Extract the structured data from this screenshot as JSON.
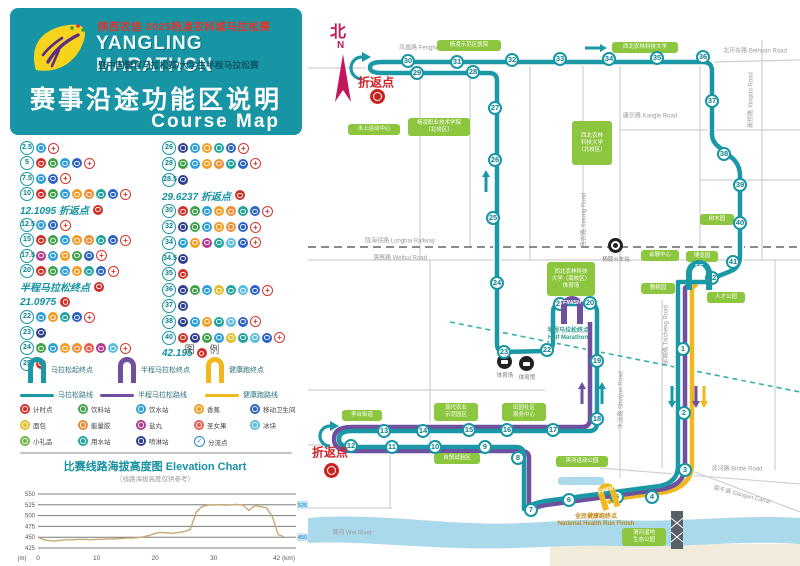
{
  "header": {
    "line1": "陕西农信·2025杨凌农科城马拉松赛",
    "title": "YANGLING MARATHON",
    "line3": "暨中国警官马拉松赛/大学生半程马拉松赛",
    "heading": "赛事沿途功能区说明",
    "subheading": "Course Map"
  },
  "km_list": {
    "left": [
      {
        "km": "2.5",
        "icons": [
          "water",
          "medical"
        ]
      },
      {
        "km": "5",
        "icons": [
          "timing",
          "drink",
          "water",
          "toilet",
          "medical"
        ]
      },
      {
        "km": "7.5",
        "icons": [
          "water",
          "toilet",
          "medical"
        ]
      },
      {
        "km": "10",
        "icons": [
          "timing",
          "drink",
          "water",
          "banana",
          "gel",
          "sponge",
          "toilet",
          "medical"
        ]
      },
      {
        "label": "12.1095 折返点",
        "icons": [
          "timing"
        ]
      },
      {
        "km": "12.5",
        "icons": [
          "water",
          "toilet",
          "medical"
        ]
      },
      {
        "km": "15",
        "icons": [
          "timing",
          "drink",
          "water",
          "banana",
          "gel",
          "sponge",
          "toilet",
          "medical"
        ]
      },
      {
        "km": "17.5",
        "icons": [
          "salt",
          "water",
          "banana",
          "drink",
          "toilet",
          "medical"
        ]
      },
      {
        "km": "20",
        "icons": [
          "timing",
          "drink",
          "water",
          "banana",
          "sponge",
          "toilet",
          "medical"
        ]
      },
      {
        "label": "半程马拉松终点",
        "icons": [
          "timing"
        ]
      },
      {
        "label": "21.0975",
        "icons": [
          "timing"
        ]
      },
      {
        "km": "22",
        "icons": [
          "water",
          "banana",
          "sponge",
          "toilet",
          "medical"
        ]
      },
      {
        "km": "23",
        "icons": [
          "spray"
        ]
      },
      {
        "km": "24",
        "icons": [
          "drink",
          "water",
          "banana",
          "gel",
          "fruit",
          "salt",
          "ice",
          "medical"
        ]
      },
      {
        "km": "25",
        "icons": [
          "timing"
        ]
      }
    ],
    "right": [
      {
        "km": "26",
        "icons": [
          "spray",
          "water",
          "banana",
          "sponge",
          "toilet",
          "medical"
        ]
      },
      {
        "km": "28",
        "icons": [
          "drink",
          "water",
          "banana",
          "gel",
          "sponge",
          "toilet",
          "medical"
        ]
      },
      {
        "km": "28.5",
        "icons": [
          "spray"
        ]
      },
      {
        "label": "29.6237 折返点",
        "icons": [
          "timing"
        ]
      },
      {
        "km": "30",
        "icons": [
          "timing",
          "drink",
          "water",
          "banana",
          "gel",
          "sponge",
          "toilet",
          "medical"
        ]
      },
      {
        "km": "32",
        "icons": [
          "spray",
          "drink",
          "water",
          "banana",
          "gel",
          "toilet",
          "medical"
        ]
      },
      {
        "km": "34",
        "icons": [
          "water",
          "banana",
          "salt",
          "sponge",
          "ice",
          "toilet",
          "medical"
        ]
      },
      {
        "km": "34.5",
        "icons": [
          "spray"
        ]
      },
      {
        "km": "35",
        "icons": [
          "timing"
        ]
      },
      {
        "km": "36",
        "icons": [
          "spray",
          "drink",
          "water",
          "bread",
          "sponge",
          "ice",
          "toilet",
          "medical"
        ]
      },
      {
        "km": "37",
        "icons": [
          "spray"
        ]
      },
      {
        "km": "38",
        "icons": [
          "spray",
          "water",
          "banana",
          "sponge",
          "ice",
          "toilet",
          "medical"
        ]
      },
      {
        "km": "40",
        "icons": [
          "timing",
          "spray",
          "drink",
          "water",
          "bread",
          "sponge",
          "ice",
          "toilet",
          "medical"
        ]
      },
      {
        "label": "42.195",
        "icons": [
          "timing"
        ]
      }
    ]
  },
  "legend": {
    "title": "图 例",
    "arches": [
      {
        "label": "马拉松起终点",
        "color": "#1b98a6"
      },
      {
        "label": "半程马拉松终点",
        "color": "#6f4f9e"
      },
      {
        "label": "健康跑终点",
        "color": "#f0b81f"
      }
    ],
    "routes": [
      {
        "label": "马拉松路线",
        "color": "#1b98a6"
      },
      {
        "label": "半程马拉松路线",
        "color": "#6f4f9e"
      },
      {
        "label": "健康跑路线",
        "color": "#f0b81f"
      }
    ],
    "items": [
      {
        "key": "timing",
        "label": "计时点"
      },
      {
        "key": "drink",
        "label": "饮料站"
      },
      {
        "key": "water",
        "label": "饮水站"
      },
      {
        "key": "banana",
        "label": "香蕉"
      },
      {
        "key": "toilet",
        "label": "移动卫生间"
      },
      {
        "key": "bread",
        "label": "面包"
      },
      {
        "key": "gel",
        "label": "能量胶"
      },
      {
        "key": "salt",
        "label": "盐丸"
      },
      {
        "key": "fruit",
        "label": "圣女果"
      },
      {
        "key": "ice",
        "label": "冰块"
      },
      {
        "key": "gift",
        "label": "小礼品"
      },
      {
        "key": "sponge",
        "label": "用水站"
      },
      {
        "key": "spray",
        "label": "喷淋站"
      },
      {
        "key": "split",
        "label": "分流点"
      }
    ],
    "icon_colors": {
      "timing": "#cf3129",
      "drink": "#3fa14a",
      "water": "#2e9fd6",
      "banana": "#f29d22",
      "toilet": "#2b62c4",
      "bread": "#e3bc2a",
      "gel": "#ef8b33",
      "salt": "#b23a8f",
      "fruit": "#e85d4c",
      "ice": "#5bbde0",
      "gift": "#6fb543",
      "sponge": "#21a39d",
      "spray": "#2e3f8f"
    }
  },
  "elevation": {
    "title_cn": "比赛线路海拔高度图",
    "title_en": "Elevation Chart",
    "note": "（线路海拔高度仅供参考）",
    "end_labels": [
      "525",
      "450"
    ]
  },
  "chart_data": {
    "type": "line",
    "title": "比赛线路海拔高度图 Elevation Chart",
    "xlabel": "距离 (km)",
    "ylabel": "海拔 (m)",
    "ylim": [
      425,
      550
    ],
    "yticks": [
      425,
      450,
      475,
      500,
      525,
      550
    ],
    "xticks": [
      0,
      10,
      20,
      30,
      42
    ],
    "x": [
      0,
      1,
      2,
      3,
      4,
      5,
      6,
      7,
      8,
      9,
      10,
      11,
      12,
      13,
      14,
      15,
      16,
      17,
      18,
      19,
      20,
      21,
      22,
      23,
      24,
      25,
      26,
      27,
      28,
      29,
      30,
      31,
      32,
      33,
      34,
      35,
      36,
      37,
      38,
      39,
      40,
      41,
      42
    ],
    "elevation_m": [
      450,
      444,
      442,
      441,
      443,
      444,
      444,
      445,
      445,
      444,
      445,
      445,
      446,
      446,
      447,
      448,
      448,
      449,
      451,
      454,
      459,
      461,
      460,
      459,
      461,
      463,
      468,
      508,
      521,
      524,
      525,
      525,
      524,
      525,
      526,
      524,
      512,
      523,
      521,
      518,
      498,
      456,
      451
    ],
    "line_color": "#c9a877",
    "grid": true
  },
  "map": {
    "north": {
      "cn": "北",
      "letter": "N"
    },
    "turnaround_label": "折返点",
    "start_finish_text": "S/F",
    "finish_text": "FINISH",
    "half_finish_label": {
      "lines": [
        "半程马拉松终点",
        "Half Marathon"
      ],
      "x": 568,
      "y": 328
    },
    "health_finish_label": {
      "lines": [
        "全民健康跑终点",
        "National Health Run Finish"
      ],
      "x": 596,
      "y": 514
    },
    "colors": {
      "marathon": "#1b98a6",
      "half": "#6f4f9e",
      "health": "#f0b81f",
      "river": "#a9d9ea"
    },
    "turnarounds": [
      {
        "tx": 376,
        "ty": 82,
        "bx": 377,
        "by": 96
      },
      {
        "tx": 330,
        "ty": 452,
        "bx": 331,
        "by": 470
      }
    ],
    "km_points": [
      {
        "n": "1",
        "x": 683,
        "y": 349
      },
      {
        "n": "2",
        "x": 684,
        "y": 413
      },
      {
        "n": "3",
        "x": 685,
        "y": 470
      },
      {
        "n": "4",
        "x": 652,
        "y": 497
      },
      {
        "n": "5",
        "x": 617,
        "y": 497
      },
      {
        "n": "6",
        "x": 569,
        "y": 500
      },
      {
        "n": "7",
        "x": 531,
        "y": 510
      },
      {
        "n": "8",
        "x": 518,
        "y": 458
      },
      {
        "n": "9",
        "x": 485,
        "y": 447
      },
      {
        "n": "10",
        "x": 435,
        "y": 447
      },
      {
        "n": "11",
        "x": 392,
        "y": 447
      },
      {
        "n": "12",
        "x": 351,
        "y": 446
      },
      {
        "n": "13",
        "x": 384,
        "y": 431
      },
      {
        "n": "14",
        "x": 423,
        "y": 431
      },
      {
        "n": "15",
        "x": 469,
        "y": 430
      },
      {
        "n": "16",
        "x": 507,
        "y": 430
      },
      {
        "n": "17",
        "x": 553,
        "y": 430
      },
      {
        "n": "18",
        "x": 597,
        "y": 419
      },
      {
        "n": "19",
        "x": 597,
        "y": 361
      },
      {
        "n": "20",
        "x": 590,
        "y": 303
      },
      {
        "n": "21",
        "x": 560,
        "y": 304
      },
      {
        "n": "22",
        "x": 547,
        "y": 350
      },
      {
        "n": "23",
        "x": 504,
        "y": 352
      },
      {
        "n": "24",
        "x": 497,
        "y": 283
      },
      {
        "n": "25",
        "x": 493,
        "y": 218
      },
      {
        "n": "26",
        "x": 495,
        "y": 160
      },
      {
        "n": "27",
        "x": 495,
        "y": 108
      },
      {
        "n": "28",
        "x": 473,
        "y": 72
      },
      {
        "n": "29",
        "x": 417,
        "y": 73
      },
      {
        "n": "30",
        "x": 408,
        "y": 61
      },
      {
        "n": "31",
        "x": 457,
        "y": 62
      },
      {
        "n": "32",
        "x": 512,
        "y": 60
      },
      {
        "n": "33",
        "x": 560,
        "y": 59
      },
      {
        "n": "34",
        "x": 609,
        "y": 59
      },
      {
        "n": "35",
        "x": 657,
        "y": 58
      },
      {
        "n": "36",
        "x": 703,
        "y": 57
      },
      {
        "n": "37",
        "x": 712,
        "y": 101
      },
      {
        "n": "38",
        "x": 724,
        "y": 154
      },
      {
        "n": "39",
        "x": 740,
        "y": 185
      },
      {
        "n": "40",
        "x": 740,
        "y": 223
      },
      {
        "n": "41",
        "x": 733,
        "y": 262
      },
      {
        "n": "42",
        "x": 712,
        "y": 278
      }
    ],
    "green_boxes": [
      {
        "lines": [
          "水上运动中心"
        ],
        "x": 348,
        "y": 124,
        "w": 52
      },
      {
        "lines": [
          "杨凌职业技术学院",
          "（北校区）"
        ],
        "x": 408,
        "y": 118,
        "w": 62
      },
      {
        "lines": [
          "杨凌示范区医院"
        ],
        "x": 437,
        "y": 40,
        "w": 64
      },
      {
        "lines": [
          "西北农林科技大学"
        ],
        "x": 612,
        "y": 42,
        "w": 66
      },
      {
        "lines": [
          "西北农林",
          "科技大学",
          "（北校区）"
        ],
        "x": 572,
        "y": 121,
        "w": 40,
        "h": 44
      },
      {
        "lines": [
          "西北农林科技",
          "大学（南校区）",
          "体育场"
        ],
        "x": 547,
        "y": 262,
        "w": 48,
        "h": 34
      },
      {
        "lines": [
          "树木园"
        ],
        "x": 700,
        "y": 214,
        "w": 34
      },
      {
        "lines": [
          "会展中心"
        ],
        "x": 641,
        "y": 250,
        "w": 38
      },
      {
        "lines": [
          "博览园"
        ],
        "x": 686,
        "y": 251,
        "w": 32
      },
      {
        "lines": [
          "教稼园"
        ],
        "x": 641,
        "y": 283,
        "w": 34
      },
      {
        "lines": [
          "人才公园"
        ],
        "x": 707,
        "y": 292,
        "w": 38
      },
      {
        "lines": [
          "李台街道"
        ],
        "x": 342,
        "y": 410,
        "w": 40
      },
      {
        "lines": [
          "现代农业",
          "示范园区"
        ],
        "x": 434,
        "y": 403,
        "w": 44
      },
      {
        "lines": [
          "田园社区",
          "服务中心"
        ],
        "x": 502,
        "y": 403,
        "w": 44
      },
      {
        "lines": [
          "自贸试验区"
        ],
        "x": 434,
        "y": 453,
        "w": 46
      },
      {
        "lines": [
          "滨河运动公园"
        ],
        "x": 556,
        "y": 456,
        "w": 52
      },
      {
        "lines": [
          "渭河湿地",
          "生态公园"
        ],
        "x": 622,
        "y": 528,
        "w": 44
      }
    ],
    "road_labels": [
      {
        "t": "凤凰路 Fenghuang Road",
        "x": 432,
        "y": 47
      },
      {
        "t": "康乐路 Kangle Road",
        "x": 650,
        "y": 115
      },
      {
        "t": "北环东路 Beihuan Road",
        "x": 755,
        "y": 50
      },
      {
        "t": "陇海铁路 Longhai Railway",
        "x": 400,
        "y": 240
      },
      {
        "t": "渭惠路 Weihui Road",
        "x": 400,
        "y": 257
      },
      {
        "t": "西农路 Xinong Road",
        "x": 583,
        "y": 220,
        "rot": -90
      },
      {
        "t": "新桥路 Xinqiao Road",
        "x": 750,
        "y": 100,
        "rot": -90
      },
      {
        "t": "邰城路 Taicheng Road",
        "x": 665,
        "y": 335,
        "rot": -90
      },
      {
        "t": "水运路 Shuiyun Road",
        "x": 620,
        "y": 400,
        "rot": -90
      },
      {
        "t": "滨河路 Binhe Road",
        "x": 737,
        "y": 468
      },
      {
        "t": "高干渠 Gaogan Canal",
        "x": 742,
        "y": 494,
        "rot": 14
      },
      {
        "t": "渭河 Wei River",
        "x": 352,
        "y": 532
      }
    ],
    "poi_icons": [
      {
        "x": 505,
        "y": 362,
        "label": "体育场",
        "type": "stadium"
      },
      {
        "x": 527,
        "y": 364,
        "label": "体育馆",
        "type": "stadium"
      },
      {
        "x": 616,
        "y": 246,
        "label": "杨陵火车站",
        "type": "station"
      }
    ]
  }
}
